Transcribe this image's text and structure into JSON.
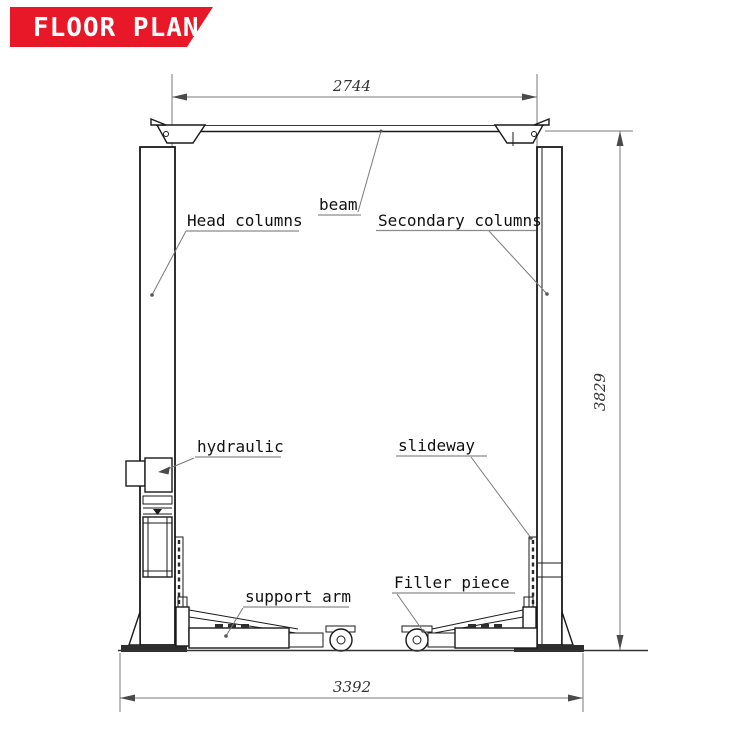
{
  "banner": {
    "title": "FLOOR PLAN"
  },
  "colors": {
    "banner_red": "#e81828",
    "line_black": "#1a1a1a",
    "leader_gray": "#7a7a7a"
  },
  "labels": {
    "head_columns": "Head columns",
    "beam": "beam",
    "secondary_columns": "Secondary columns",
    "hydraulic": "hydraulic",
    "slideway": "slideway",
    "support_arm": "support arm",
    "filler_piece": "Filler piece"
  },
  "dimensions": {
    "beam_span": "2744",
    "overall_height": "3829",
    "base_span": "3392"
  }
}
